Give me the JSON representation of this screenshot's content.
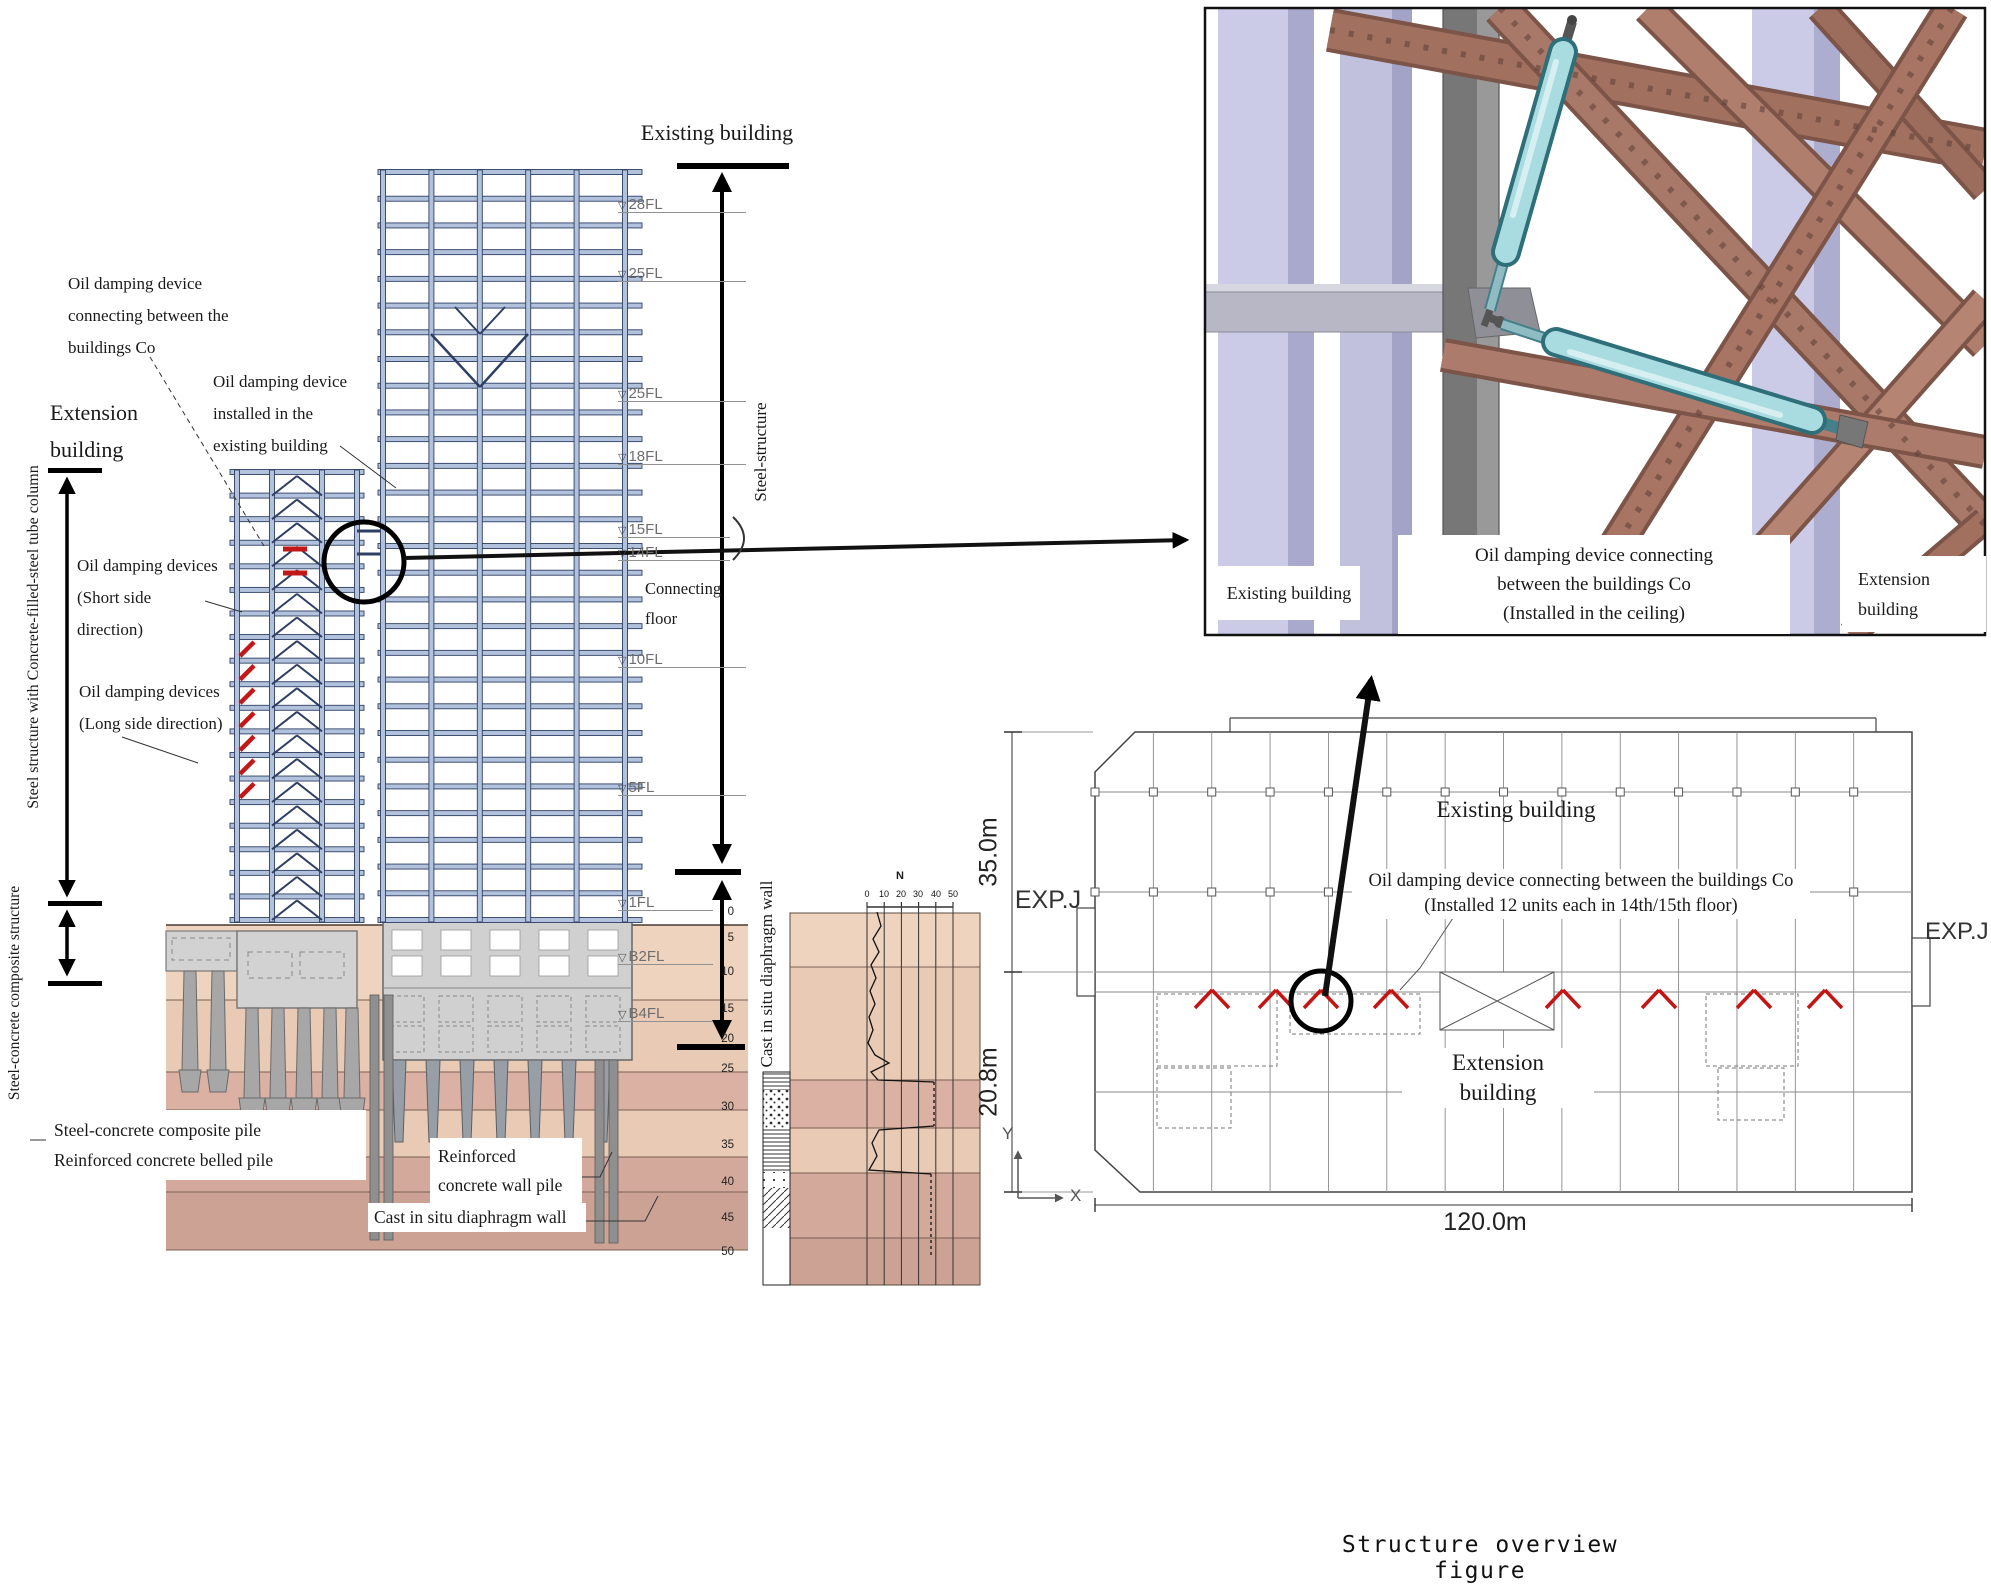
{
  "elevation": {
    "title_existing": "Existing building",
    "title_extension": [
      "Extension",
      "building"
    ],
    "label_damper_connecting": [
      "Oil damping device",
      "connecting between the",
      "buildings Co"
    ],
    "label_damper_installed": [
      "Oil damping device",
      "installed in the",
      "existing building"
    ],
    "label_dampers_short": [
      "Oil damping devices",
      "(Short side",
      "direction)"
    ],
    "label_dampers_long": [
      "Oil damping devices",
      "(Long side direction)"
    ],
    "label_connecting_floor": [
      "Connecting",
      "floor"
    ],
    "vertical_cft": "Steel structure with Concrete-filled-steel tube column",
    "vertical_src": "Steel-concrete composite structure",
    "vertical_steel": "Steel-structure",
    "vertical_diaphragm": "Cast in situ diaphragm wall",
    "marker_glyph": "▽",
    "floor_labels": [
      "28FL",
      "25FL",
      "25FL",
      "18FL",
      "15FL",
      "14FL",
      "10FL",
      "5FL",
      "1FL",
      "B2FL",
      "B4FL"
    ],
    "depth_ticks": [
      "0",
      "5",
      "10",
      "15",
      "20",
      "25",
      "30",
      "35",
      "40",
      "45",
      "50"
    ],
    "borehole": {
      "n_label": "N",
      "scale_ticks": [
        "0",
        "10",
        "20",
        "30",
        "40",
        "50"
      ]
    },
    "box_composite_pile": [
      "Steel-concrete composite pile",
      "Reinforced concrete belled pile"
    ],
    "box_wall_pile": [
      "Reinforced",
      "concrete wall pile"
    ],
    "box_diaphragm": "Cast in situ diaphragm wall"
  },
  "detail3d": {
    "label_existing": "Existing building",
    "label_damper": [
      "Oil damping device connecting",
      "between the buildings Co",
      "(Installed in the ceiling)"
    ],
    "label_extension": [
      "Extension",
      "building"
    ]
  },
  "plan": {
    "label_existing": "Existing building",
    "annotation": [
      "Oil damping device connecting between the buildings Co",
      "(Installed 12 units each in 14th/15th floor)"
    ],
    "label_extension": [
      "Extension",
      "building"
    ],
    "exp_j_left": "EXP.J",
    "exp_j_right": "EXP.J",
    "dim_width": "120.0m",
    "dim_upper": "35.0m",
    "dim_lower": "20.8m",
    "axis_x": "X",
    "axis_y": "Y"
  },
  "caption": "Structure overview figure",
  "colors": {
    "beam_fill": "#b3c2dc",
    "beam_stroke": "#2e3f63",
    "damper_red": "#c31818",
    "soil_light": "#eed3bf",
    "soil_dark": "#dab1a3",
    "cyan_damper": "#a9dce0",
    "brace_brown": "#a87869",
    "column_lavender": "#cbcbe7"
  }
}
